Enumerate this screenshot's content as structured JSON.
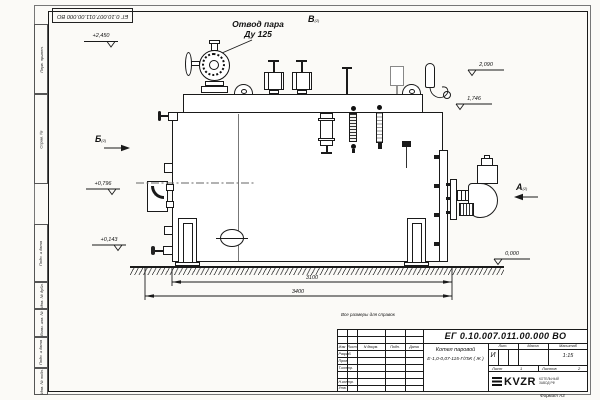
{
  "top_stamp": {
    "doc_number_inverted": "ЕГ 0.10.007.011.00.000  ВО"
  },
  "labels": {
    "steam_outlet_line1": "Отвод пара",
    "steam_outlet_line2": "Ду 125",
    "view_a": "А",
    "view_b": "Б",
    "view_v": "В",
    "view_sheet_ref": "(2)"
  },
  "elevations": {
    "top_left": "+2,450",
    "mid_left": "+0,796",
    "low_left": "+0,143",
    "top_right": "2,090",
    "mid_right": "1,746",
    "ground_right": "0,000"
  },
  "dimensions": {
    "inner": "3100",
    "overall": "3400"
  },
  "side_labels": [
    "Перв. примен.",
    "Справ. №",
    "Подп. и дата",
    "Инв. № дубл.",
    "Взам. инв. №",
    "Подп. и дата",
    "Инв. № подл."
  ],
  "title_block": {
    "note": "Все размеры для справок",
    "doc_number": "ЕГ 0.10.007.011.00.000  ВО",
    "product_name": "Котел паровой",
    "product_designation": "Е-1,0-0,07-115-Г/ЛЖ ( Ж )",
    "col_izm": "Изм",
    "col_list": "Лист",
    "col_ndoc": "N докум.",
    "col_podp": "Подп.",
    "col_data": "Дата",
    "row_razrab": "Разраб.",
    "row_prov": "Пров.",
    "row_tkontr": "Т.контр.",
    "row_nkontr": "Н.контр.",
    "row_utv": "Утв.",
    "lit_header": "Лит.",
    "lit_value": "И",
    "mass_header": "Масса",
    "scale_header": "Масштаб",
    "scale_value": "1:15",
    "sheet_label": "Лист",
    "sheet_value": "1",
    "sheets_label": "Листов",
    "sheets_value": "2",
    "logo_text": "KVZR",
    "logo_tag1": "КОТЕЛЬНЫЙ",
    "logo_tag2": "ЗАВОД РФ",
    "format": "Формат А3"
  }
}
